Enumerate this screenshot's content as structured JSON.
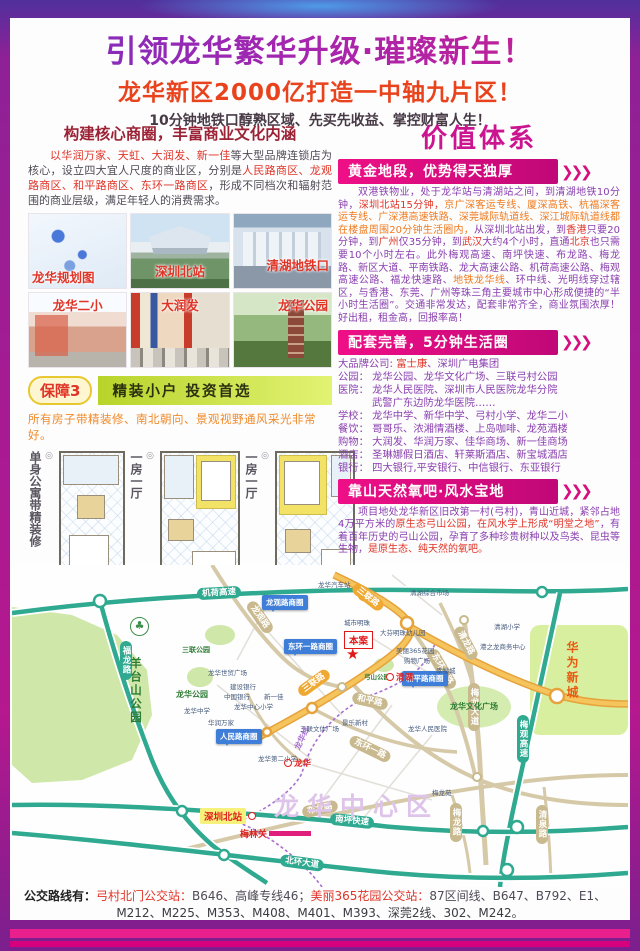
{
  "header": {
    "title": "引领龙华繁华升级·璀璨新生！",
    "subtitle": "龙华新区2000亿打造一中轴九片区！",
    "tagline": "10分钟地铁口醇熟区域、先买先收益、掌控财富人生！"
  },
  "left": {
    "section_title": "构建核心商圈，丰富商业文化内涵",
    "intro": [
      {
        "t": "以华润万家、天虹、大润发、新一佳",
        "c": "r"
      },
      {
        "t": "等大型品牌连锁店为核心，设立四大宜人尺度的商业区，分别是",
        "c": "d"
      },
      {
        "t": "人民路商区、龙观路商区、和平路商区、东环一路商区",
        "c": "r"
      },
      {
        "t": "，形成不同档次和辐射范围的商业层级，满足年轻人的消费需求。",
        "c": "d"
      }
    ],
    "photos": [
      "龙华规划图",
      "深圳北站",
      "清湖地铁口",
      "龙华二小",
      "大润发",
      "龙华公园"
    ],
    "guarantee": {
      "badge": "保障3",
      "bar": "精装小户 投资首选",
      "note": "所有房子带精装修、南北朝向、景观视野通风采光非常好。"
    },
    "floorplans": [
      "单身公寓带精装修",
      "一房一厅",
      "一房一厅"
    ]
  },
  "right": {
    "title": "价值体系",
    "s1": {
      "banner": "黄金地段，优势得天独厚",
      "parts": [
        {
          "t": "双港铁物业，处于龙华站与清湖站之间，到清湖地铁10分钟，",
          "c": "p"
        },
        {
          "t": "深圳北站15分钟，",
          "c": "r"
        },
        {
          "t": "京广深客运专线、厦深高铁、杭福深客运专线、广深港高速铁路、深莞城际轨道线、深江城际轨道线都在楼盘周围20分钟生活圈内，",
          "c": "o"
        },
        {
          "t": "从深圳北站出发，到",
          "c": "p"
        },
        {
          "t": "香港",
          "c": "r"
        },
        {
          "t": "只要20分钟，到",
          "c": "p"
        },
        {
          "t": "广州",
          "c": "r"
        },
        {
          "t": "仅35分钟，到",
          "c": "p"
        },
        {
          "t": "武汉",
          "c": "r"
        },
        {
          "t": "大约4个小时，直通",
          "c": "p"
        },
        {
          "t": "北京",
          "c": "r"
        },
        {
          "t": "也只需要10个小时左右。此外梅观高速、南坪快速、布龙路、梅龙路、新区大道、平南铁路、龙大高速公路、机荷高速公路、梅观高速公路、福龙快速路、",
          "c": "p"
        },
        {
          "t": "地铁龙华线",
          "c": "o"
        },
        {
          "t": "、环中线、光明线穿过辖区，与香港、东莞、广州等珠三角主要城市中心形成便捷的“半小时生活圈”。交通非常发达，配套非常齐全，商业氛围浓厚！好出租，租金高，回报率高！",
          "c": "p"
        }
      ]
    },
    "s2": {
      "banner": "配套完善，5分钟生活圈",
      "lines": [
        [
          {
            "t": "大品牌公司: ",
            "c": "p"
          },
          {
            "t": "富士康",
            "c": "r"
          },
          {
            "t": "、深圳广电集团",
            "c": "p"
          }
        ],
        [
          {
            "t": "公园： 龙华公园、龙华文化广场、三联弓村公园",
            "c": "p"
          }
        ],
        [
          {
            "t": "医院： 龙华人民医院、深圳市人民医院龙华分院",
            "c": "p"
          }
        ],
        [
          {
            "t": "武警广东边防龙华医院……",
            "c": "p"
          }
        ],
        [
          {
            "t": "学校： 龙华中学、新华中学、弓村小学、龙华二小",
            "c": "p"
          }
        ],
        [
          {
            "t": "餐饮： 哥哥乐、浓湘情酒楼、上岛咖啡、龙苑酒楼",
            "c": "p"
          }
        ],
        [
          {
            "t": "购物： 大润发、华润万家、佳华商场、新一佳商场",
            "c": "p"
          }
        ],
        [
          {
            "t": "酒店： 圣琳娜假日酒店、轩莱斯酒店、新宝城酒店",
            "c": "p"
          }
        ],
        [
          {
            "t": "银行： 四大银行,平安银行、中信银行、东亚银行",
            "c": "p"
          }
        ]
      ]
    },
    "s3": {
      "banner": "靠山天然氧吧·风水宝地",
      "parts": [
        {
          "t": "项目地处龙华新区旧改第一村(弓村)，青山近城，紧邻占地4万平方米的",
          "c": "p"
        },
        {
          "t": "原生态弓山公园，在风水学上形成“明堂之地”",
          "c": "r"
        },
        {
          "t": "，有着百年历史的弓山公园，孕育了多种珍贵树种以及鸟类、昆虫等生物，",
          "c": "p"
        },
        {
          "t": "是原生态、纯天然的氧吧。",
          "c": "r"
        }
      ]
    },
    "chevrons": "❯❯❯"
  },
  "map": {
    "roads": {
      "jihe": "机荷高速",
      "fulong": "福龙路",
      "meiguan": "梅观高速",
      "nanping": "南坪快速",
      "beihuan": "北环大道",
      "sanlian_a": "三联路",
      "sanlian_b": "三联路",
      "longguan": "龙观路",
      "donghuan1": "东环一路",
      "donghuan2": "东环二路",
      "heping": "和平路",
      "qinglong": "清龙路",
      "meilong_ave": "梅龙大道",
      "meilong_rd": "梅龙路",
      "qingquan": "清泉路",
      "bulong": "布龙路",
      "metro": "龙华线"
    },
    "areas": {
      "yangtaishan": "羊台山公园",
      "huawei": "华为新城",
      "sanlian_park": "三联公园",
      "longhua_park": "龙华公园",
      "gongshan_park": "弓山公园",
      "culture_square": "龙华文化广场"
    },
    "callouts": {
      "longguan": "龙观路商圈",
      "donghuan": "东环一路商圈",
      "heping": "和平路商圈",
      "renmin": "人民路商圈"
    },
    "stations": {
      "qinghu": "清湖",
      "longhua": "龙华",
      "shenzhen_north": "深圳北站",
      "meilin": "梅林关"
    },
    "site": "本案",
    "district": "龙华中心区",
    "pois": {
      "bus_station": "龙华汽车站",
      "qinghu_market": "清湖综合市场",
      "qinghu_school": "清湖小学",
      "gangzhilong": "港之龙商务中心",
      "chengshi_mingzhu": "城市明珠",
      "mingzhu_kg": "大芬明珠幼儿园",
      "meili365": "美丽365花园",
      "shopping": "购物广场",
      "xingfucheng": "幸福城",
      "shimao": "龙华世贸广场",
      "ccb": "建设银行",
      "boc": "中国银行",
      "xinyijia": "新一佳",
      "center_school": "龙华中心小学",
      "longhua_ms": "龙华中学",
      "vanguard": "华润万家",
      "hospital": "龙华人民医院",
      "wenti_square": "三联文体广场",
      "second_school": "龙华第二小学",
      "jingle": "景乐新村",
      "meilongyuan": "梅龙苑"
    }
  },
  "footer": {
    "line1": [
      {
        "t": "公交路线有：",
        "c": "k"
      },
      {
        "t": "弓村北门公交站：",
        "c": "r"
      },
      {
        "t": "B646、高峰专线46；",
        "c": "d"
      },
      {
        "t": "美丽365花园公交站：",
        "c": "r"
      },
      {
        "t": "87区间线、B647、B792、E1、",
        "c": "d"
      }
    ],
    "line2": "M212、M225、M353、M408、M401、M393、深莞2线、302、M242。"
  }
}
